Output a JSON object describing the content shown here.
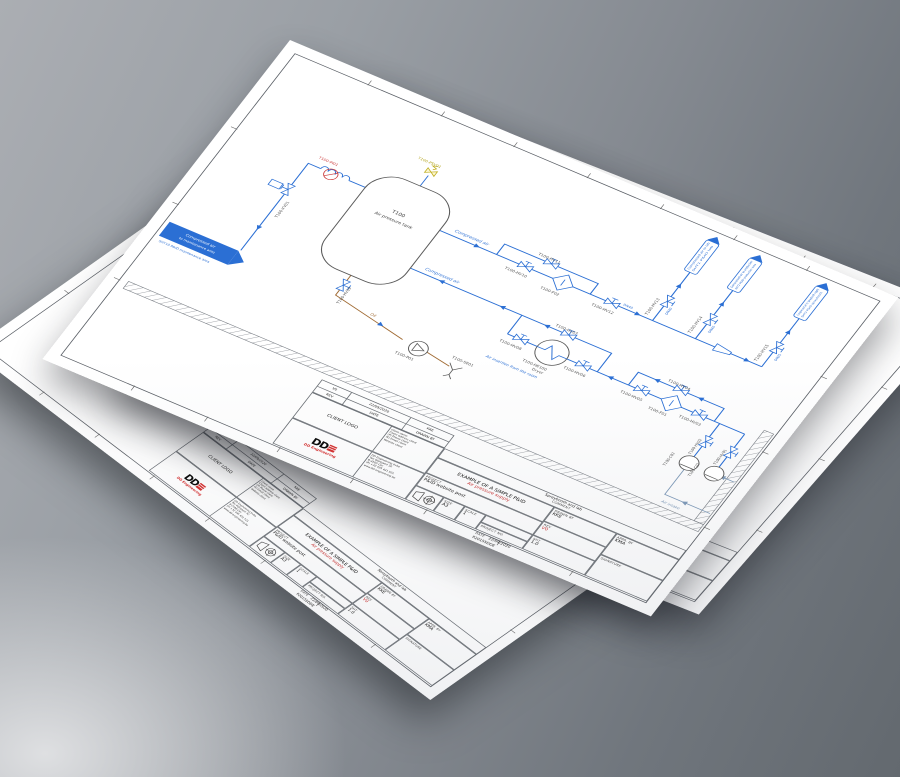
{
  "scene": {
    "sheet_count": 3,
    "background_hex": "#858a91",
    "paper_hex": "#ffffff"
  },
  "titleblock": {
    "comment_value": "Spraybooth and lab",
    "comment_label": "COMMENT",
    "title": "EXAMPLE OF A SIMPLE P&ID",
    "subtitle": "Air pressure supply",
    "project_label": "PROJECT",
    "project_value": "P&ID website post",
    "size_label": "SIZE",
    "size_value": "A3",
    "scale_label": "SCALE",
    "scale_value": "1",
    "projectno_label": "PROJECT NO.",
    "projectno_value": "P20155DDE",
    "date_label": "DATE",
    "date_value": "22/09/2020",
    "drawnby_label": "DRAWN BY",
    "drawnby_value": "KKE",
    "apprby_label": "APPR. BY",
    "apprby_value": "KMA",
    "rev_label": "REV",
    "rev_value": "V0",
    "sht_label": "SHT",
    "sht_value": "1.0",
    "signature_label": "SIGNATURE",
    "client_logo_label": "CLIENT LOGO",
    "client_lines": [
      "Client name",
      "Client address client",
      "(P) Phone client",
      "(E) Email client",
      "Website client"
    ],
    "dde_lines": [
      "DD Engineering bvba",
      "Ten Wijngaert 32",
      "B-2500 Lier",
      "(P) +32 495 421 521",
      "www.dd-engineering.be"
    ],
    "logo_text": "DD",
    "logo_sub": "DD Engineering",
    "rev_row": {
      "rev": "V0",
      "date": "22/09/2020",
      "by": "KKE"
    },
    "rev_head": {
      "rev": "REV",
      "date": "DATE",
      "by": "DRAWN BY"
    }
  },
  "diagram": {
    "tank_tag": "T100",
    "tank_name": "Air pressure tank",
    "psv_label": "T100-PSV01",
    "gauge_label": "T100-PI01",
    "xv_label": "T100-XV01",
    "valves": {
      "hv01": "T100-HV01",
      "hv02": "T100-HV02",
      "hv03": "T100-HV03",
      "hv04": "T100-HV04",
      "hv05": "T100-HV05",
      "hv06": "T100-HV06",
      "hv07": "T100-HV07",
      "hv08": "T100-HV08",
      "hv09": "T100-HV09",
      "hv10": "T100-HV10",
      "hv11": "T100-HV11",
      "hv12": "T100-HV12",
      "hv13": "T100-HV13",
      "hv14": "T100-HV14",
      "hv15": "T100-HV15"
    },
    "equipment": {
      "f01": "T100-F01",
      "f02": "T100-F02",
      "he": "T100-HE100",
      "he_sub": "Dryer",
      "p01": "T100-P01",
      "se01": "T100-SE01",
      "c01": "T100-C01",
      "c02": "T100-C02"
    },
    "flows": {
      "compressed_air_supply": "Compressed air",
      "compressed_air_return": "Compressed air",
      "oil": "Oil",
      "air_intake": "Air intake",
      "air_insertion": "Air insertion from the room",
      "dn40_main": "DN40",
      "dn40_branch1": "DN40",
      "dn40_branch2": "DN40",
      "dn25_branch3": "DN25"
    },
    "connectors": {
      "maintenance": {
        "line1": "Compressed air",
        "line2": "to maintenance area",
        "sub": "SHT10 P&ID maintenance area"
      },
      "lab": {
        "text": "Compressed air to lab",
        "sub": "SHT1 P&ID lab"
      },
      "production": {
        "text": "Compressed air to production",
        "sub": "SHT2 P&ID production area"
      },
      "spraybooth": {
        "text": "Compressed air to spraybooth supply",
        "sub": "SHT3 P&ID spraybooth"
      }
    },
    "colors": {
      "pipe": "#2b6fd4",
      "oil": "#a06a32",
      "intake": "#7d98b6",
      "psv": "#bfae1e",
      "instrument": "#cc3b3b",
      "accent_red": "#c53434"
    }
  }
}
